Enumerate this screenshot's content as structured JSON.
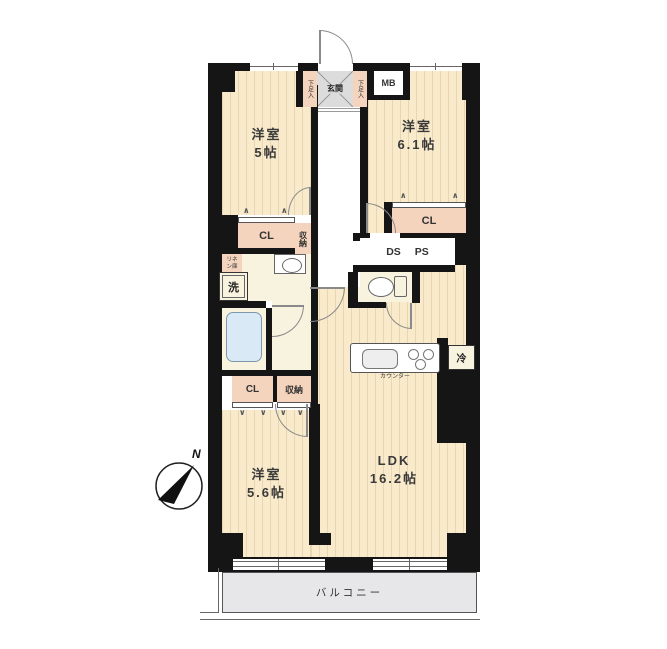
{
  "colors": {
    "wall": "#151515",
    "room_floor": "#F8EACB",
    "service_floor": "#F8F3DE",
    "closet_fill": "#F5D4BE",
    "entrance_tile": "#DCDCDC",
    "balcony_fill": "#E7E7E9",
    "bathtub_fill": "#D9EAF6",
    "outline": "#555555"
  },
  "rooms": {
    "west_room_top_left": {
      "name": "洋室",
      "size": "5帖"
    },
    "west_room_top_right": {
      "name": "洋室",
      "size": "6.1帖"
    },
    "west_room_bottom": {
      "name": "洋室",
      "size": "5.6帖"
    },
    "ldk": {
      "name": "LDK",
      "size": "16.2帖"
    }
  },
  "labels": {
    "entrance": "玄関",
    "shoe_cabinet_left": "下足入",
    "shoe_cabinet_right": "下足入",
    "meter_box": "MB",
    "closet_top_left": "CL",
    "closet_top_right": "CL",
    "closet_bottom": "CL",
    "storage_upper": "収納",
    "storage_lower": "収納",
    "duct_space": "DS",
    "pipe_space": "PS",
    "linen_line1": "リネ",
    "linen_line2": "ン庫",
    "washing_machine": "洗",
    "kitchen_counter": "カウンター",
    "refrigerator": "冷",
    "balcony": "バルコニー",
    "compass_north": "N"
  }
}
